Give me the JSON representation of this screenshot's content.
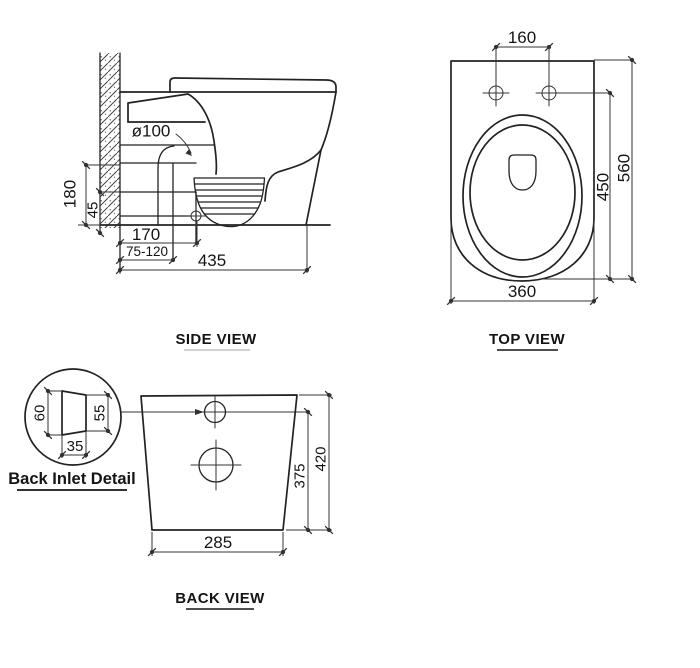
{
  "side": {
    "label": "SIDE VIEW",
    "d_pipe": "ø100",
    "d180": "180",
    "d45": "45",
    "d170": "170",
    "d75_120": "75-120",
    "d435": "435"
  },
  "top": {
    "label": "TOP VIEW",
    "d160": "160",
    "d450": "450",
    "d560": "560",
    "d360": "360"
  },
  "inlet": {
    "label": "Back Inlet Detail",
    "d60": "60",
    "d55": "55",
    "d35": "35"
  },
  "back": {
    "label": "BACK VIEW",
    "d375": "375",
    "d420": "420",
    "d285": "285"
  },
  "colors": {
    "line": "#222222",
    "dimension_line": "#333333",
    "text": "#141414",
    "background": "#ffffff"
  }
}
